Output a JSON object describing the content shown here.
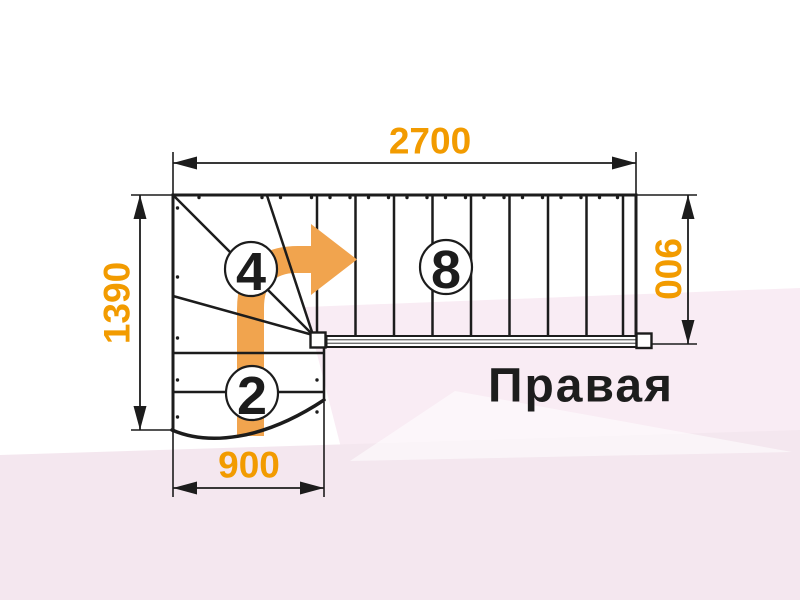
{
  "plan": {
    "label": "Правая",
    "dimensions": {
      "top_width": "2700",
      "left_height": "1390",
      "right_width": "900",
      "bottom_width": "900"
    },
    "step_counts": {
      "winder_flight": "4",
      "upper_flight": "8",
      "lower_flight": "2"
    }
  },
  "colors": {
    "dimension_text": "#F29B00",
    "direction_arrow": "#F1A44E",
    "outline": "#1C1C1C",
    "background_tint": "#F9ECF4"
  }
}
